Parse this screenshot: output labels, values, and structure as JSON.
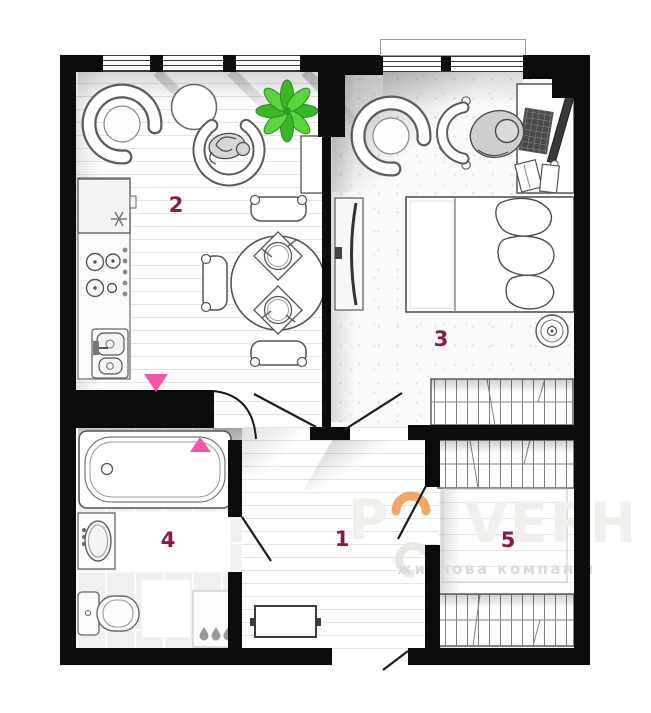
{
  "plan": {
    "rooms": [
      {
        "label": "1"
      },
      {
        "label": "2"
      },
      {
        "label": "3"
      },
      {
        "label": "4"
      },
      {
        "label": "5"
      }
    ]
  },
  "watermark": {
    "letters": [
      "P",
      "V",
      "E",
      "R",
      "H"
    ],
    "subtitle": "житлова компанія"
  },
  "colors": {
    "wall": "#0c0c0c",
    "room_label": "#8a1a4e",
    "arrow_pink": "#f156a8",
    "plant_green": "#3cb42c",
    "wm_text": "#f1f0ec",
    "wm_orange": "#f4a668",
    "wm_sub": "#dbdbd7"
  }
}
